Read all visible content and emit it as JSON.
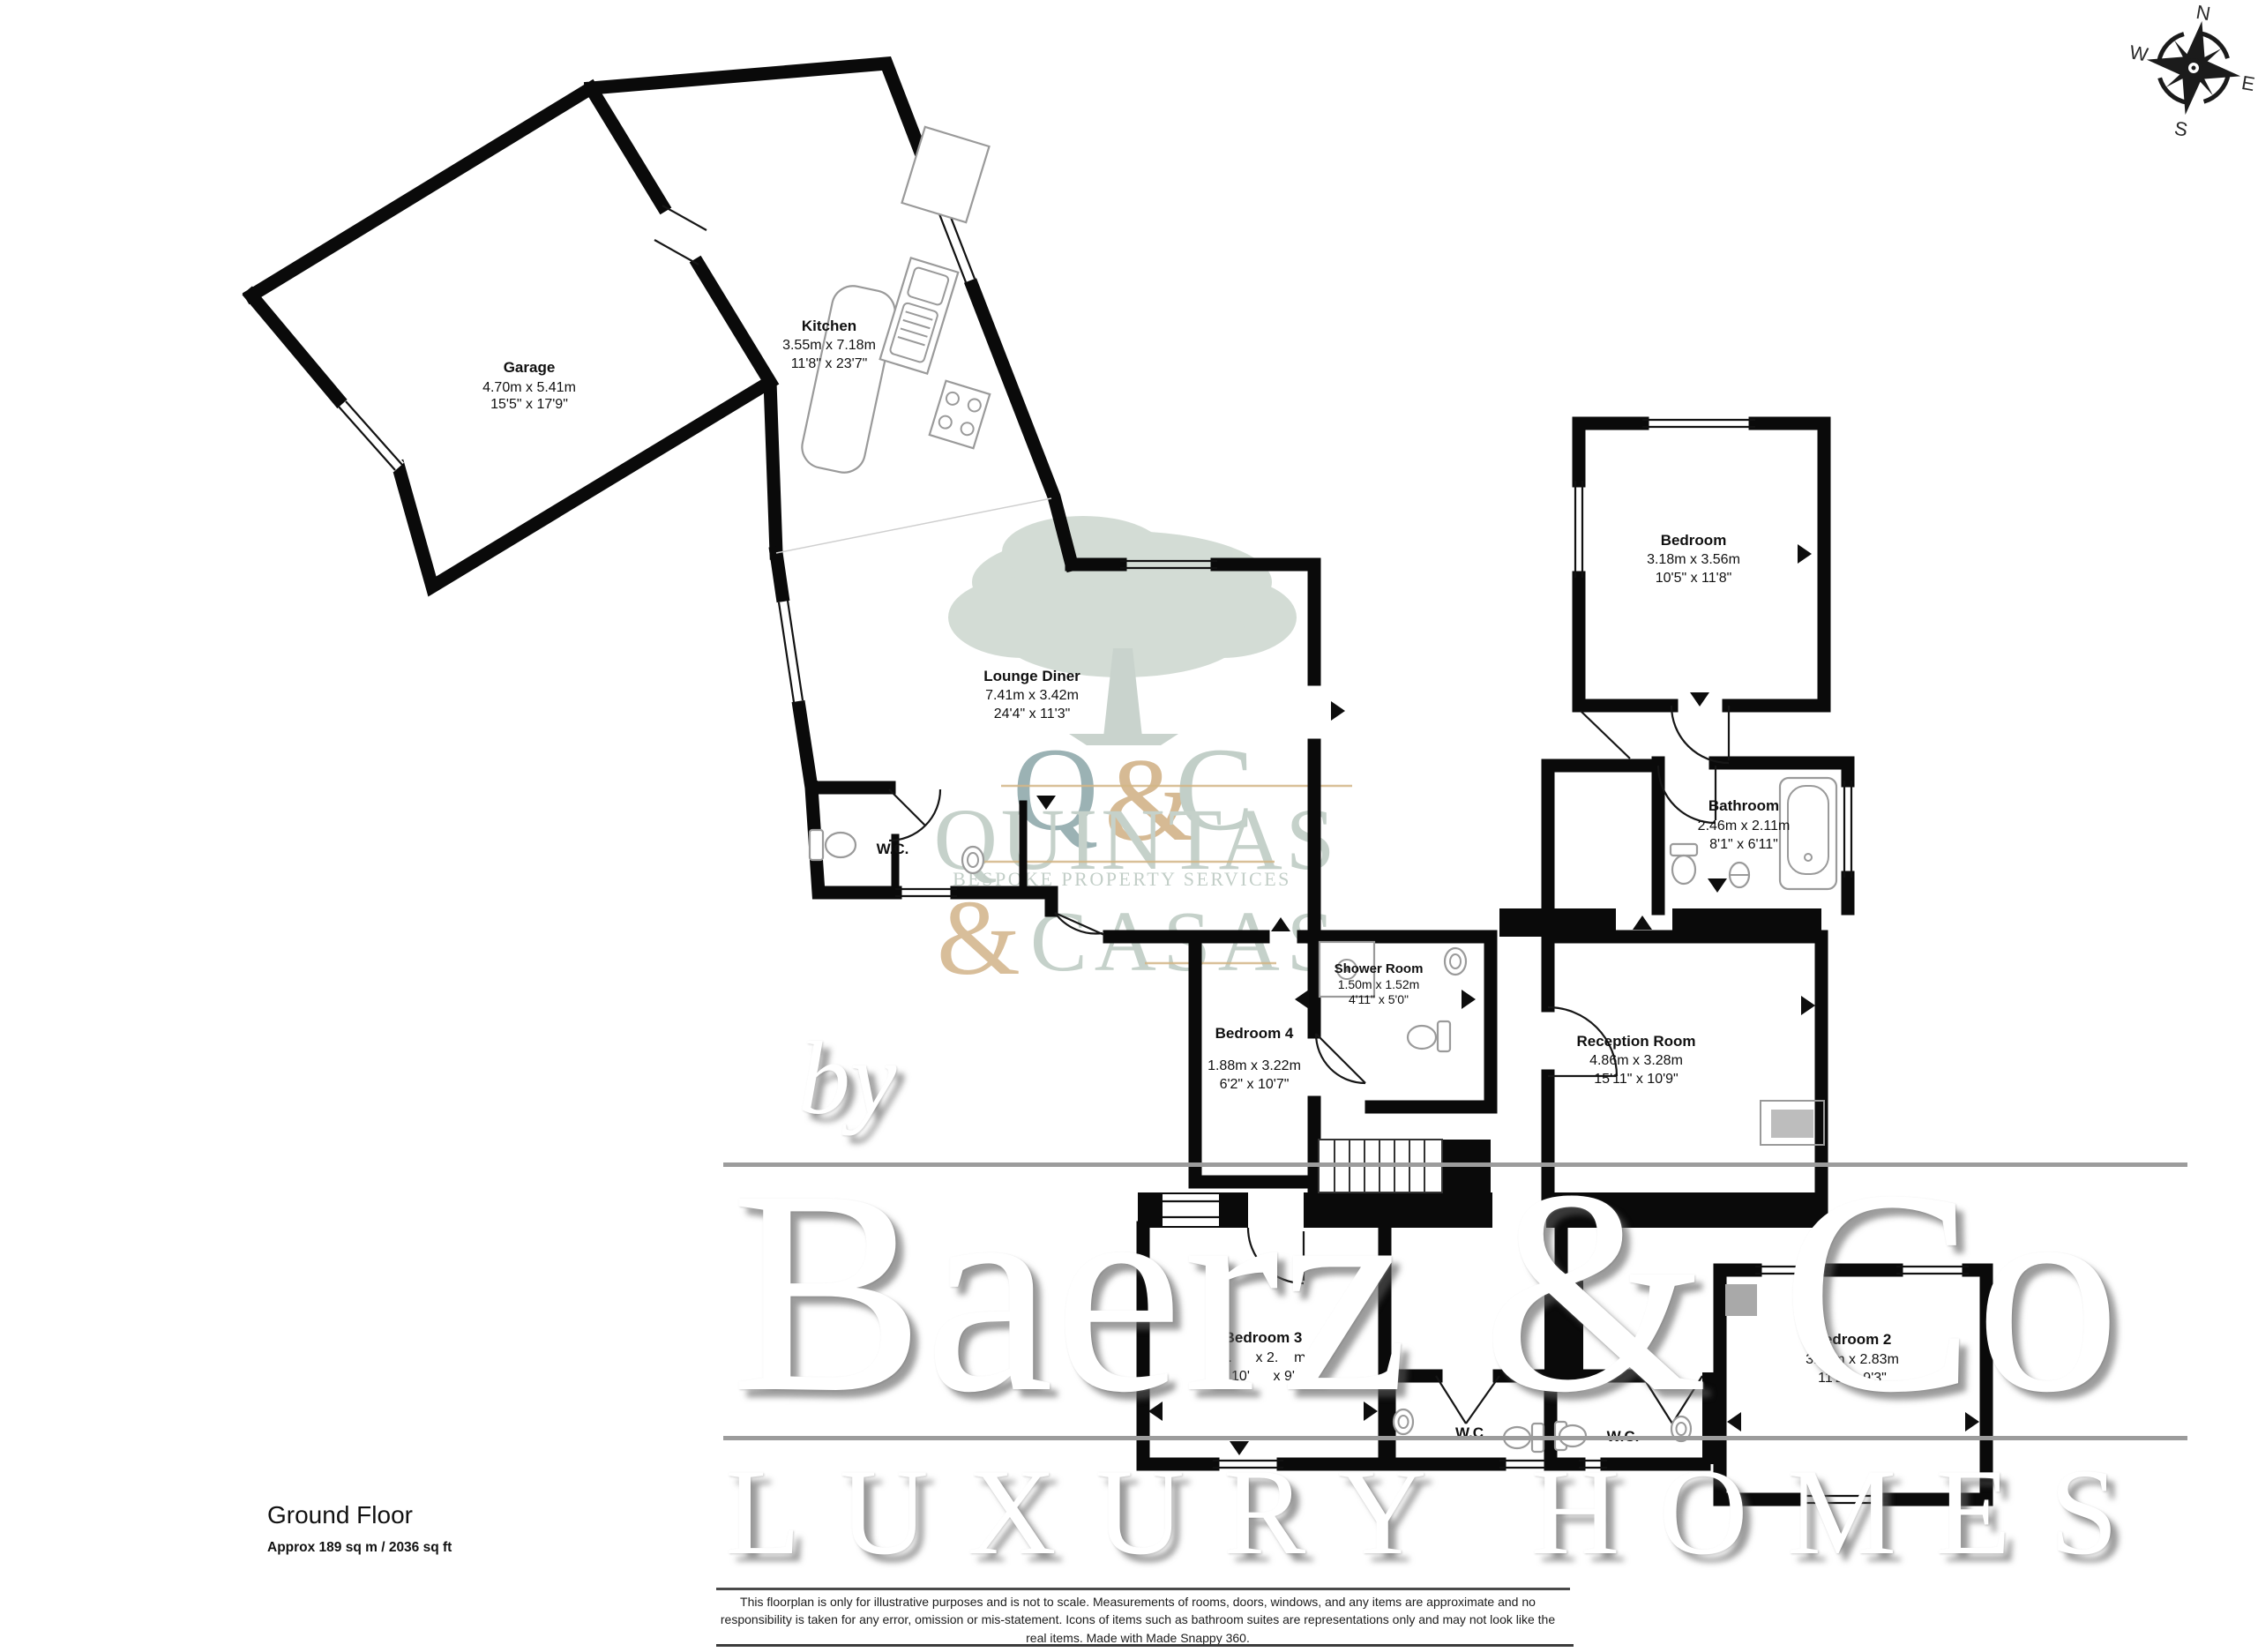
{
  "compass": {
    "north": "N",
    "east": "E",
    "south": "S",
    "west": "W"
  },
  "rooms": [
    {
      "id": "garage",
      "name": "Garage",
      "dims_m": "4.70m x 5.41m",
      "dims_ft": "15'5\" x 17'9\""
    },
    {
      "id": "kitchen",
      "name": "Kitchen",
      "dims_m": "3.55m x 7.18m",
      "dims_ft": "11'8\" x 23'7\""
    },
    {
      "id": "lounge-diner",
      "name": "Lounge Diner",
      "dims_m": "7.41m x 3.42m",
      "dims_ft": "24'4\" x 11'3\""
    },
    {
      "id": "bedroom",
      "name": "Bedroom",
      "dims_m": "3.18m x 3.56m",
      "dims_ft": "10'5\" x 11'8\""
    },
    {
      "id": "bathroom",
      "name": "Bathroom",
      "dims_m": "2.46m x 2.11m",
      "dims_ft": "8'1\" x 6'11\""
    },
    {
      "id": "shower-room",
      "name": "Shower Room",
      "dims_m": "1.50m x 1.52m",
      "dims_ft": "4'11\" x 5'0\""
    },
    {
      "id": "bedroom-4",
      "name": "Bedroom 4",
      "dims_m": "1.88m x 3.22m",
      "dims_ft": "6'2\" x 10'7\""
    },
    {
      "id": "reception-room",
      "name": "Reception Room",
      "dims_m": "4.86m x 3.28m",
      "dims_ft": "15'11\" x 10'9\""
    },
    {
      "id": "bedroom-3",
      "name": "Bedroom 3",
      "dims_m": "3.      x 2.    m",
      "dims_ft": "10'      x 9'"
    },
    {
      "id": "bedroom-2",
      "name": "Bedroom 2",
      "dims_m": "3.41m x 2.83m",
      "dims_ft": "11'2\" x 9'3\""
    }
  ],
  "wc": {
    "lounge": "W.C.",
    "bottom_left": "W.C",
    "bottom_right": "W.C."
  },
  "footer": {
    "floor_title": "Ground Floor",
    "floor_area": "Approx 189 sq m / 2036 sq ft",
    "disclaimer": "This floorplan is only for illustrative purposes and is not to scale. Measurements of rooms, doors, windows, and any items are approximate and no responsibility is taken for any error, omission or mis-statement. Icons of items such as bathroom suites are representations only and may not look like the real items. Made with Made Snappy 360."
  },
  "watermarks": {
    "brand": {
      "monogram_q": "Q",
      "monogram_amp": "&",
      "monogram_c": "C",
      "word1": "QUINTAS",
      "tagline": "BESPOKE PROPERTY SERVICES",
      "word2_amp": "&",
      "word2": "CASAS"
    },
    "agency": {
      "prefix": "by",
      "name": "Baerz & Co",
      "tagline": "LUXURY HOMES"
    }
  },
  "colors": {
    "wall": "#0a0a0a",
    "brand_teal": "#5f8387",
    "brand_gold": "#c49a63",
    "brand_sage": "#b7c6bd"
  }
}
